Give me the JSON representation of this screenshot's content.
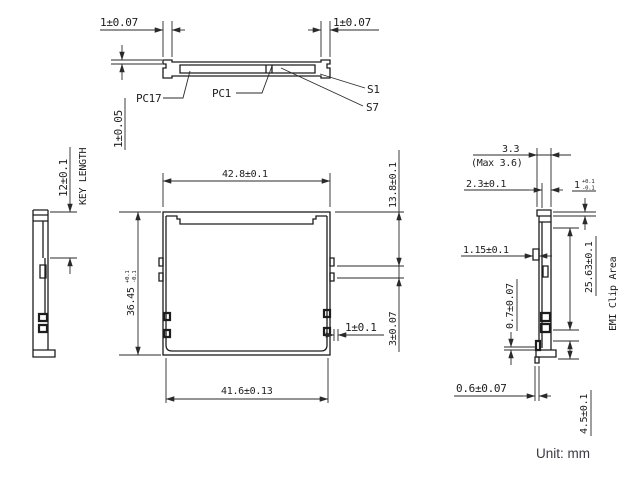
{
  "unit_label": "Unit: mm",
  "colors": {
    "line": "#1d1d1d",
    "dim_line": "#2a2a2a",
    "unit_text": "#3a3a42",
    "background": "#ffffff"
  },
  "top_view": {
    "dim_left_tab": "1±0.07",
    "dim_right_tab": "1±0.07",
    "dim_thickness": "1±0.05",
    "label_pc17": "PC17",
    "label_pc1": "PC1",
    "label_s1": "S1",
    "label_s7": "S7"
  },
  "left_view": {
    "dim_key_length": "12±0.1",
    "caption_key_length": "KEY LENGTH"
  },
  "front_view": {
    "dim_width": "42.8±0.1",
    "dim_width_inner": "41.6±0.13",
    "dim_height": "36.45",
    "dim_height_tol_upper": "+0.1",
    "dim_height_tol_lower": "-0.1",
    "dim_side_upper": "13.8±0.1",
    "dim_side_lower": "3±0.07",
    "dim_notch": "1±0.1"
  },
  "right_view": {
    "dim_thickness": "3.3",
    "dim_thickness_max": "(Max 3.6)",
    "dim_body": "2.3±0.1",
    "dim_lip": "1",
    "dim_lip_tol_upper": "+0.1",
    "dim_lip_tol_lower": "-0.1",
    "dim_rail": "1.15±0.1",
    "dim_emi_height": "25.63±0.1",
    "caption_emi": "EMI Clip Area",
    "dim_clip_thickness": "0.7±0.07",
    "dim_foot": "4.5±0.1",
    "dim_toe": "0.6±0.07"
  }
}
